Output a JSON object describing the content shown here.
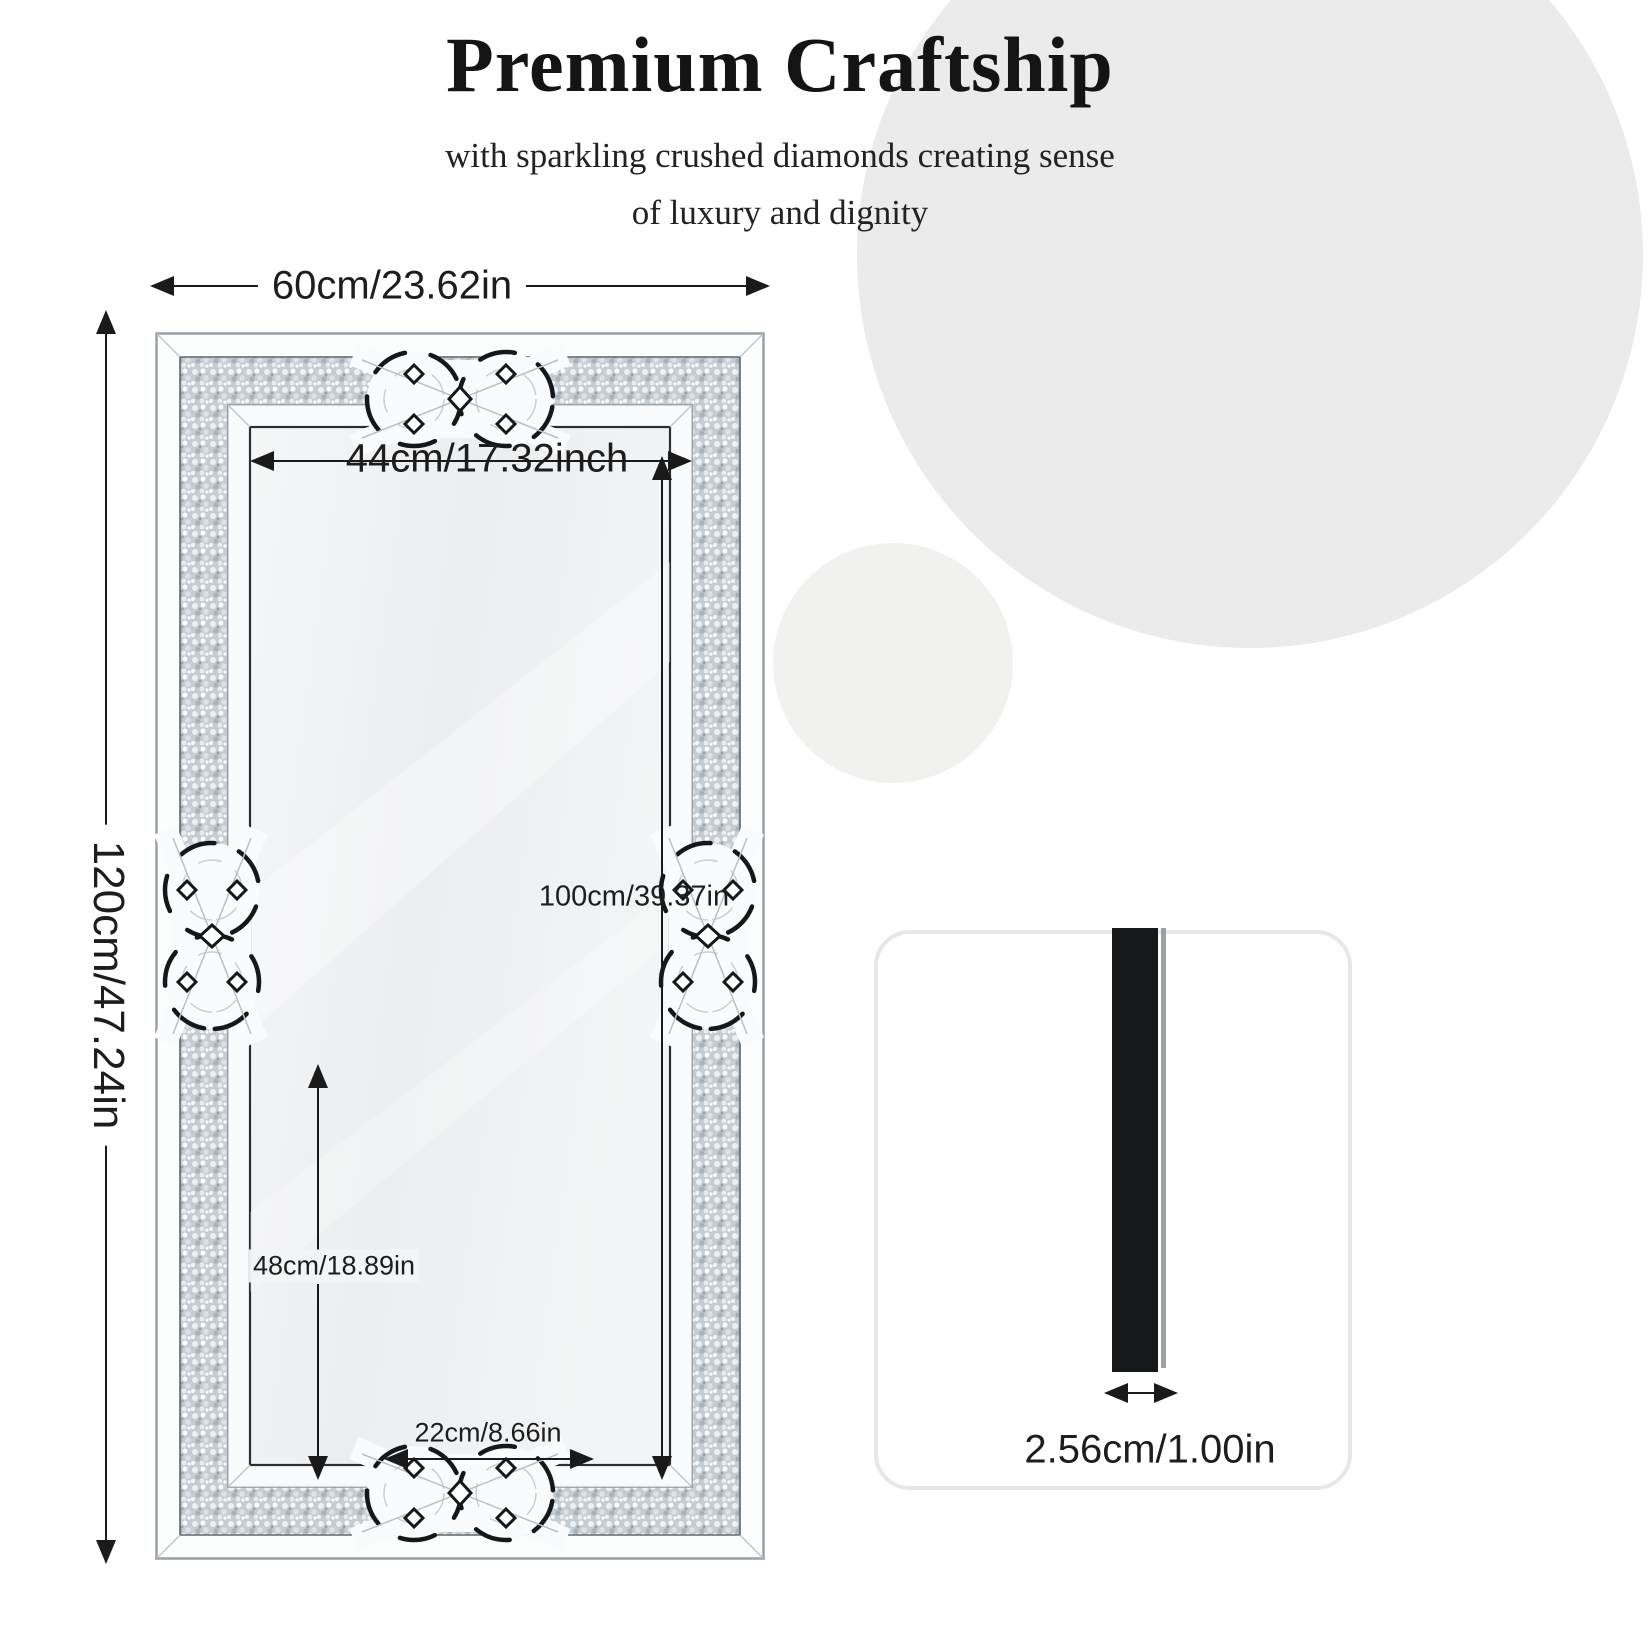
{
  "header": {
    "title": "Premium Craftship",
    "subtitle_line1": "with sparkling crushed diamonds creating sense",
    "subtitle_line2": "of luxury and dignity"
  },
  "mirror_diagram": {
    "description": "front view of rectangular crushed-diamond wall mirror with celtic knot ornaments",
    "labels": {
      "outer_width": "60cm/23.62in",
      "outer_height": "120cm/47.24in",
      "inner_width": "44cm/17.32inch",
      "inner_height": "100cm/39.37in",
      "lower_section_height": "48cm/18.89in",
      "bottom_inner_width": "22cm/8.66in"
    }
  },
  "side_profile": {
    "thickness_label": "2.56cm/1.00in"
  },
  "icons": {
    "dimension_arrow": "double-headed measurement arrow",
    "knot_ornament": "interlaced celtic knot mirror ornament"
  },
  "colors": {
    "background": "#ffffff",
    "accent_circle_large": "#ebebeb",
    "accent_circle_small": "#f1f1ef",
    "dimension_line": "#1a1a1a",
    "frame_white": "#fafbfc",
    "crushed_diamond_band": "#c6ccd1",
    "inner_mirror": "#f0f2f4",
    "profile_bar": "#17181a",
    "card_border": "#e7e7e7",
    "text": "#1a1a1a"
  }
}
